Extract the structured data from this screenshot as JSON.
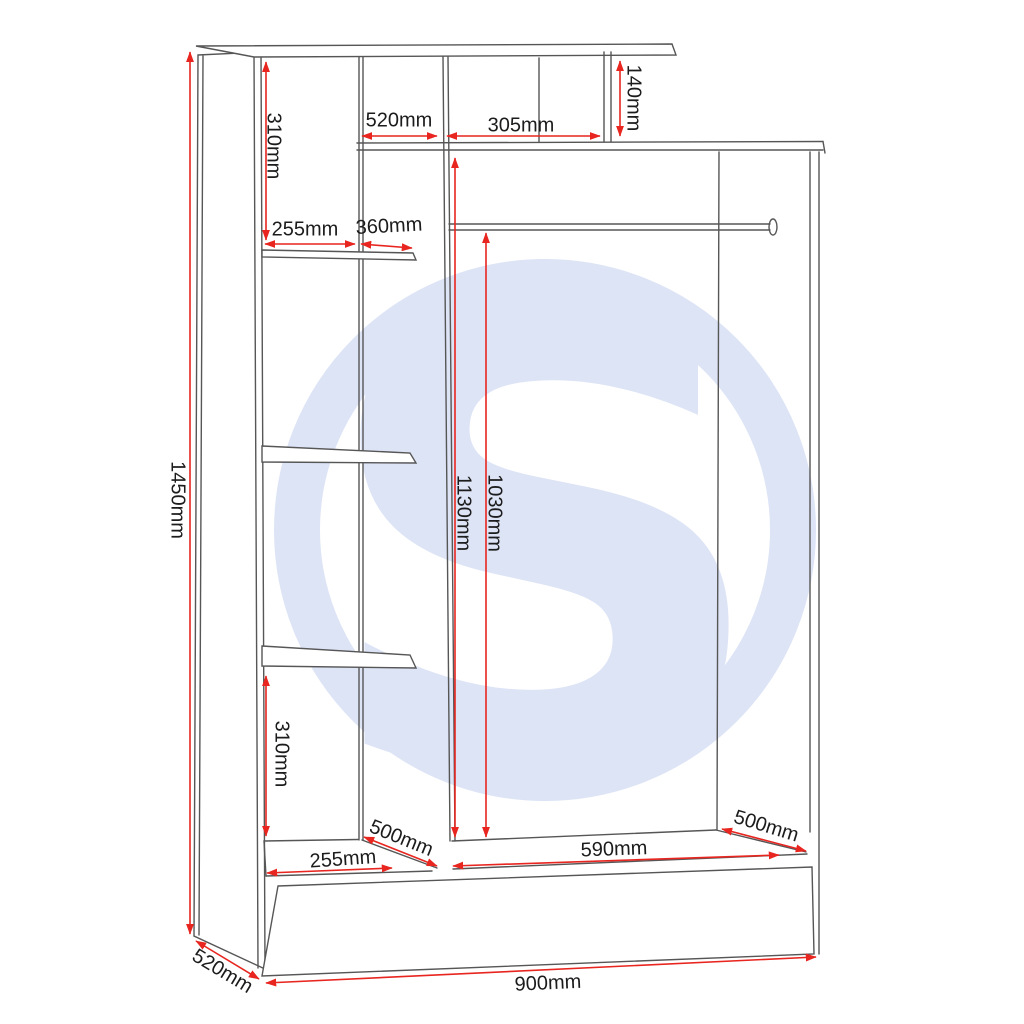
{
  "drawing": {
    "type": "wardrobe-dimension-diagram",
    "background": "#ffffff"
  },
  "colors": {
    "dimension_red": "#e8251f",
    "structure_gray": "#565656",
    "label_text": "#1c1c1c",
    "watermark_blue": "#dde4f6"
  },
  "watermark": {
    "letter": "S"
  },
  "dimensions": [
    {
      "name": "overall-height",
      "label": "1450mm"
    },
    {
      "name": "upper-left-gap",
      "label": "310mm"
    },
    {
      "name": "top-shelf-depth",
      "label": "520mm"
    },
    {
      "name": "top-shelf-width",
      "label": "305mm"
    },
    {
      "name": "top-shelf-height",
      "label": "140mm"
    },
    {
      "name": "shelf-column-width",
      "label": "255mm"
    },
    {
      "name": "shelf-depth",
      "label": "360mm"
    },
    {
      "name": "hanging-height-total",
      "label": "1130mm"
    },
    {
      "name": "rail-drop-height",
      "label": "1030mm"
    },
    {
      "name": "lower-left-gap",
      "label": "310mm"
    },
    {
      "name": "left-floor-depth",
      "label": "500mm"
    },
    {
      "name": "left-floor-width",
      "label": "255mm"
    },
    {
      "name": "hanging-floor-width",
      "label": "590mm"
    },
    {
      "name": "right-floor-depth",
      "label": "500mm"
    },
    {
      "name": "overall-width",
      "label": "900mm"
    },
    {
      "name": "overall-depth",
      "label": "520mm"
    }
  ]
}
